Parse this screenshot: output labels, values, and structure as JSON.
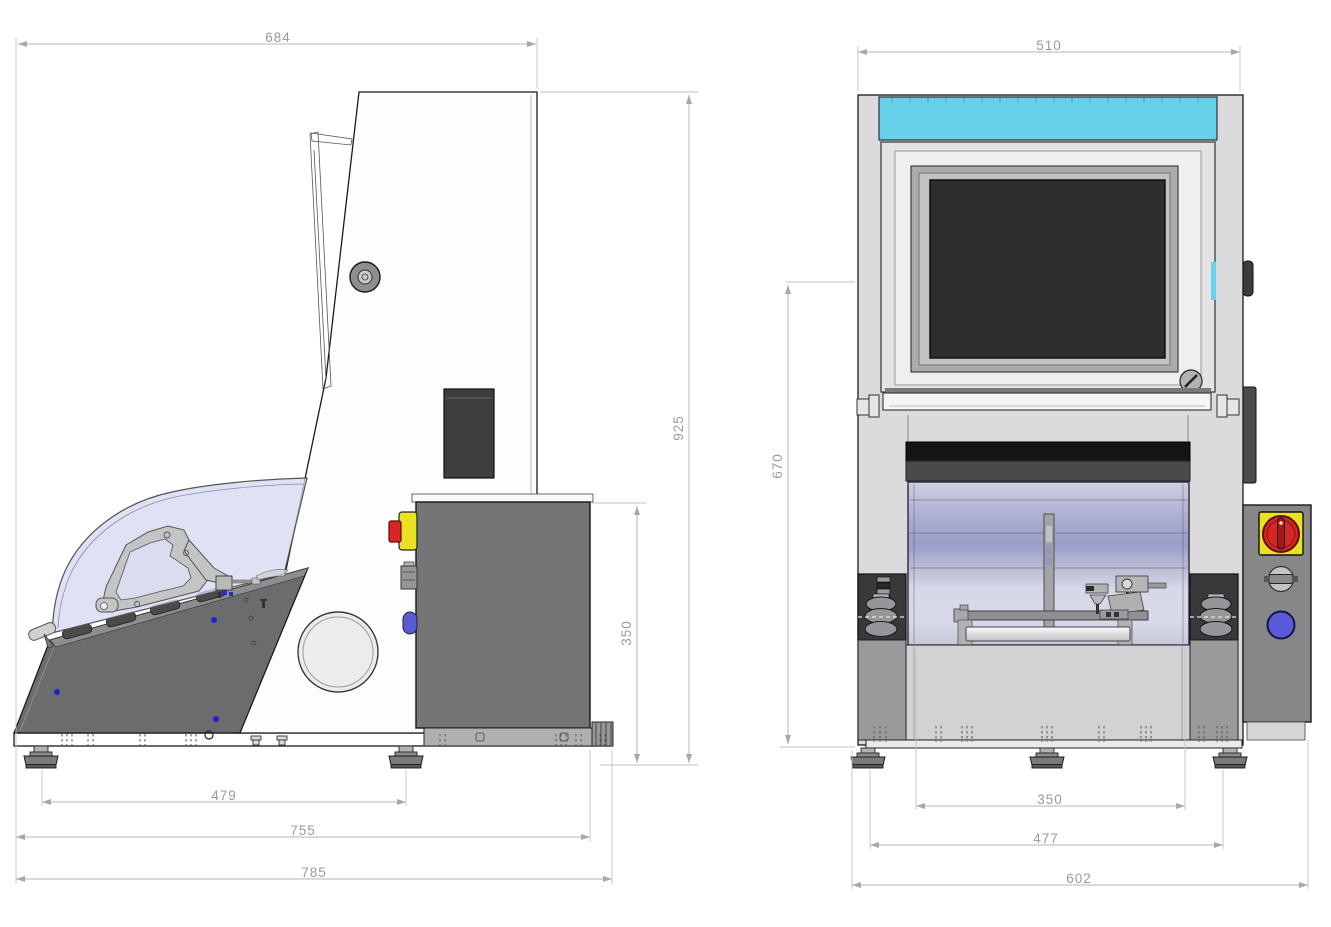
{
  "drawing_title": "Two-view dimensioned machine drawing (side view and front view)",
  "side_view": {
    "label": "side view",
    "dim_top_width": "684",
    "dim_overall_height": "925",
    "dim_cabinet_height": "350",
    "dim_foot_pitch": "479",
    "dim_base_length": "755",
    "dim_overall_length": "785"
  },
  "front_view": {
    "label": "front view",
    "dim_top_width": "510",
    "dim_door_height": "670",
    "dim_chamber_width": "350",
    "dim_foot_pitch": "477",
    "dim_overall_width": "602"
  },
  "colors": {
    "dimension_gray": "#a8a8aa",
    "accent_cyan": "#67d1e9",
    "dome_lavender": "#d6d8f2",
    "chamber_violet": "#9b9ec7",
    "screen_black": "#2d2d2f",
    "estop_red": "#d82626",
    "estop_yellow": "#e8e222",
    "button_blue": "#5a5ad8",
    "panel_dark_gray": "#6c6c6e",
    "cabinet_gray": "#757577"
  }
}
